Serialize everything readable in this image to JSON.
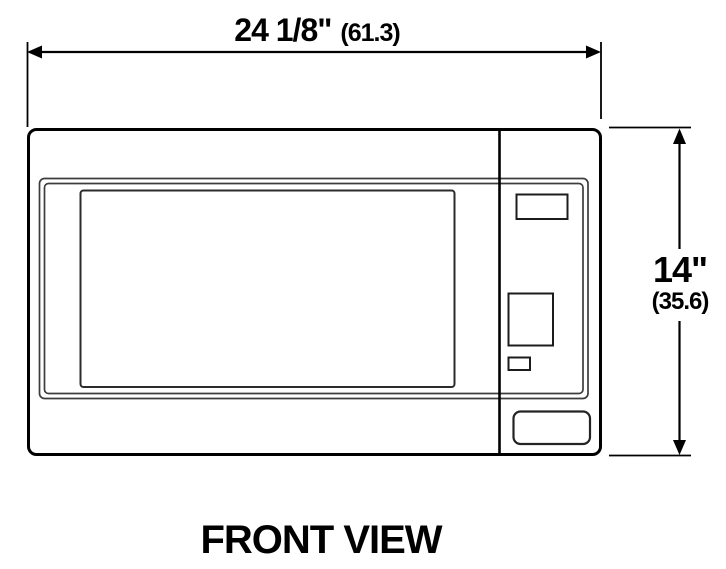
{
  "title": "FRONT VIEW",
  "dimensions": {
    "width": {
      "imperial": "24 1/8\"",
      "metric_cm": "(61.3)"
    },
    "height": {
      "imperial": "14\"",
      "metric_cm": "(35.6)"
    }
  },
  "colors": {
    "line": "#000000",
    "thin_line": "#3d3d3d",
    "background": "#ffffff"
  }
}
